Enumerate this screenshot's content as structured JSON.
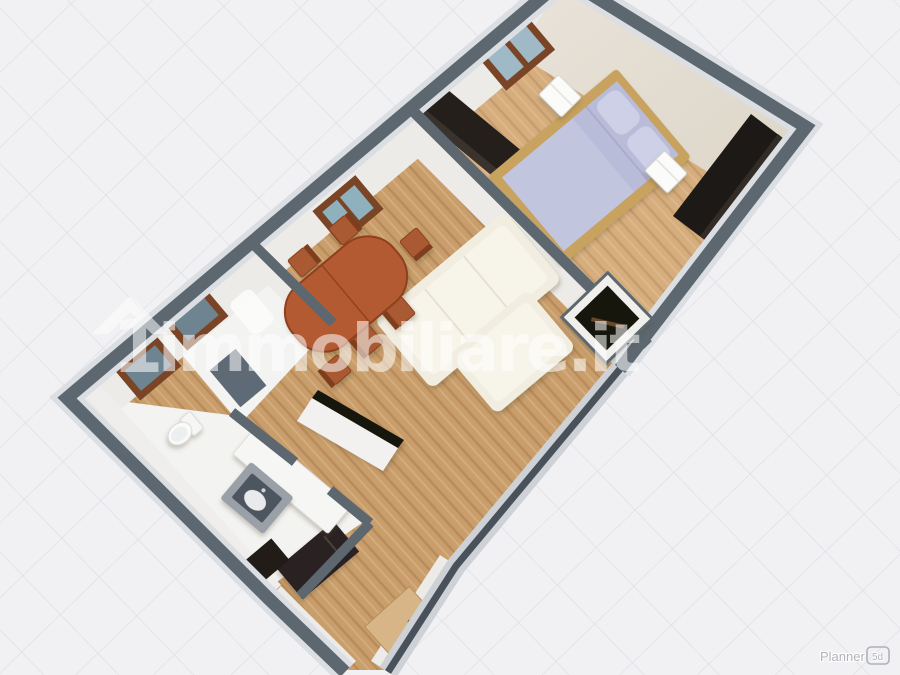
{
  "watermark": {
    "logo_glyph": "1",
    "text": "immobiliare.it",
    "color": "#ffffff",
    "opacity": 0.55
  },
  "planner": {
    "label": "Planner",
    "badge": "5d",
    "color": "#aeb2ba"
  },
  "palette": {
    "background": "#f1f1f3",
    "grid_line": "#d7dae1",
    "wall_top": "#5c6770",
    "wall_halo": "#dbdee2",
    "wall_face": "#edebe7",
    "wall_face_beige": "#e5dfd5",
    "wood_living": "#c99e6b",
    "wood_bedroom": "#d6ae7e",
    "floor_white": "#f3f3f2",
    "window_frame": "#7a4526",
    "window_glass": "#9fbac6",
    "window_glass_dark": "#6e8490",
    "dining_table": "#b45a32",
    "chair": "#aa5a31",
    "sofa": "#f1ede1",
    "bed_frame": "#c8a25f",
    "bed_linen": "#b9bcd8",
    "pillow": "#cdd0e6",
    "dark_furniture": "#241f1b",
    "entry_door": "#d7b586",
    "sink_gray": "#99a0a8",
    "shower_dark": "#4e565f",
    "rim_dark": "#49525b"
  },
  "scene": {
    "view": "3d-isometric-floorplan",
    "rooms": [
      {
        "name": "bedroom",
        "floor": "wood-light",
        "objects": [
          "double-bed",
          "nightstand",
          "nightstand",
          "wardrobe-dark",
          "wardrobe-dark",
          "window"
        ]
      },
      {
        "name": "living-dining",
        "floor": "wood",
        "objects": [
          "dining-table",
          "dining-chairs-x6",
          "corner-sofa",
          "corner-tv-niche",
          "kitchen-counter",
          "window"
        ]
      },
      {
        "name": "anteroom",
        "floor": "white",
        "objects": [
          "dark-rug",
          "white-mat",
          "window",
          "window"
        ]
      },
      {
        "name": "bathroom",
        "floor": "white",
        "objects": [
          "toilet",
          "vanity-counter",
          "gray-sink-unit"
        ]
      },
      {
        "name": "hallway",
        "floor": "wood",
        "objects": [
          "dark-cabinet",
          "dark-desk",
          "entry-door"
        ]
      }
    ]
  }
}
